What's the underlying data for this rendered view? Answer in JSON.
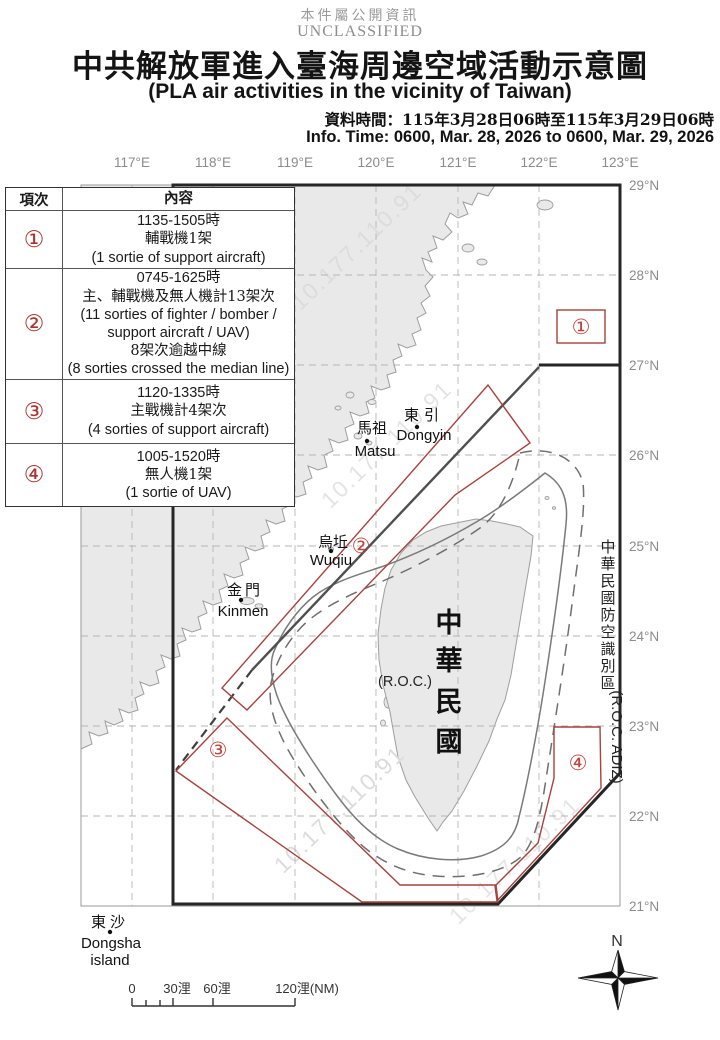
{
  "header": {
    "classification_zh": "本件屬公開資訊",
    "classification_en": "UNCLASSIFIED",
    "title_zh": "中共解放軍進入臺海周邊空域活動示意圖",
    "title_en": "(PLA air activities in the vicinity of Taiwan)",
    "info_time_zh": "資料時間：115年3月28日06時至115年3月29日06時",
    "info_time_en": "Info. Time: 0600, Mar. 28, 2026 to 0600, Mar. 29, 2026"
  },
  "table": {
    "headers": [
      "項次",
      "內容"
    ],
    "rows": [
      {
        "no": "①",
        "lines": [
          "1135-1505時",
          "輔戰機1架",
          "(1 sortie of support aircraft)"
        ]
      },
      {
        "no": "②",
        "lines": [
          "0745-1625時",
          "主、輔戰機及無人機計13架次",
          "(11 sorties of fighter / bomber /",
          "support aircraft / UAV)",
          "8架次逾越中線",
          "(8 sorties crossed the median line)"
        ]
      },
      {
        "no": "③",
        "lines": [
          "1120-1335時",
          "主戰機計4架次",
          "(4 sorties of support aircraft)"
        ]
      },
      {
        "no": "④",
        "lines": [
          "1005-1520時",
          "無人機1架",
          "(1 sortie of UAV)"
        ]
      }
    ]
  },
  "map": {
    "lon_labels": [
      "117°E",
      "118°E",
      "119°E",
      "120°E",
      "121°E",
      "122°E",
      "123°E"
    ],
    "lat_labels": [
      "29°N",
      "28°N",
      "27°N",
      "26°N",
      "25°N",
      "24°N",
      "23°N",
      "22°N",
      "21°N"
    ],
    "markers": [
      "①",
      "②",
      "③",
      "④"
    ],
    "adiz_chars": [
      "中",
      "華",
      "民",
      "國",
      "防",
      "空",
      "識",
      "別",
      "區"
    ],
    "adiz_en": "(R.O.C. ADIZ)",
    "taiwan_chars": [
      "中",
      "華",
      "民",
      "國"
    ],
    "roc_label": "(R.O.C.)",
    "places": {
      "dongyin_zh": "東引",
      "dongyin_en": "Dongyin",
      "matsu_zh": "馬祖",
      "matsu_en": "Matsu",
      "wuqiu_zh": "烏坵",
      "wuqiu_en": "Wuqiu",
      "kinmen_zh": "金門",
      "kinmen_en": "Kinmen",
      "dongsha_zh": "東沙",
      "dongsha_en1": "Dongsha",
      "dongsha_en2": "island"
    },
    "scale_labels": [
      "0",
      "30浬",
      "60浬",
      "120浬(NM)"
    ],
    "compass_n": "N",
    "watermark": "10.177.110.91"
  },
  "colors": {
    "activity_red": "#a8423c",
    "marker_red": "#bf453d",
    "land_fill": "#e9e9e9",
    "coast_stroke": "#9e9e9e",
    "adiz_line": "#262626",
    "median_line": "#4f4f4f",
    "grid": "#b5b5b5",
    "axis_text": "#8b8b8b",
    "watermark_gray": "#dcdcdc"
  }
}
